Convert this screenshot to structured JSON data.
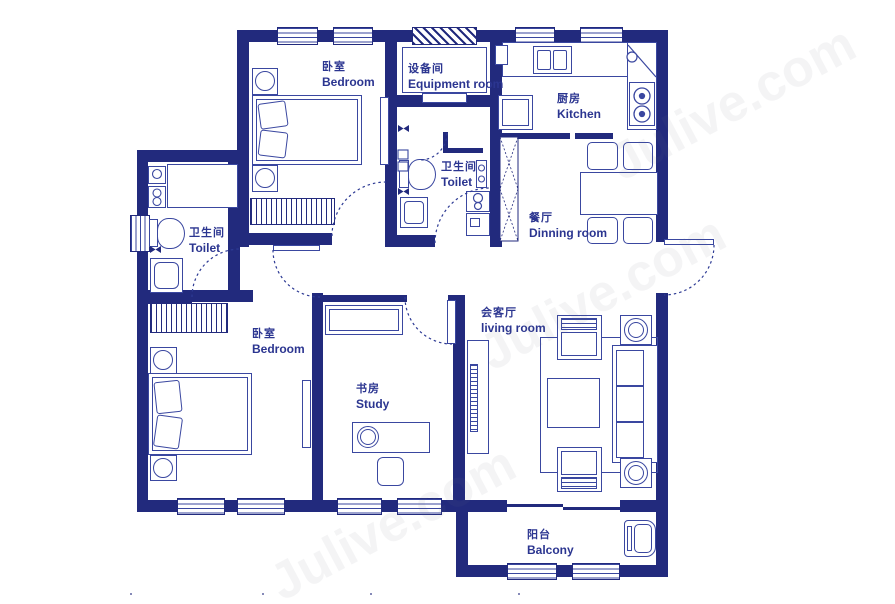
{
  "meta": {
    "type": "apartment-floor-plan",
    "watermark": "Julive.com"
  },
  "colors": {
    "wall": "#222a7d",
    "furniture_line": "#3a47a0",
    "label_text": "#2b3590",
    "background": "#ffffff"
  },
  "rooms": {
    "bedroom_top": {
      "zh": "卧室",
      "en": "Bedroom"
    },
    "equipment": {
      "zh": "设备间",
      "en": "Equipment room"
    },
    "kitchen": {
      "zh": "厨房",
      "en": "Kitchen"
    },
    "toilet_mid": {
      "zh": "卫生间",
      "en": "Toilet"
    },
    "dining": {
      "zh": "餐厅",
      "en": "Dinning room"
    },
    "toilet_left": {
      "zh": "卫生间",
      "en": "Toilet"
    },
    "bedroom_bottom": {
      "zh": "卧室",
      "en": "Bedroom"
    },
    "study": {
      "zh": "书房",
      "en": "Study"
    },
    "living": {
      "zh": "会客厅",
      "en": "living room"
    },
    "balcony": {
      "zh": "阳台",
      "en": "Balcony"
    }
  }
}
